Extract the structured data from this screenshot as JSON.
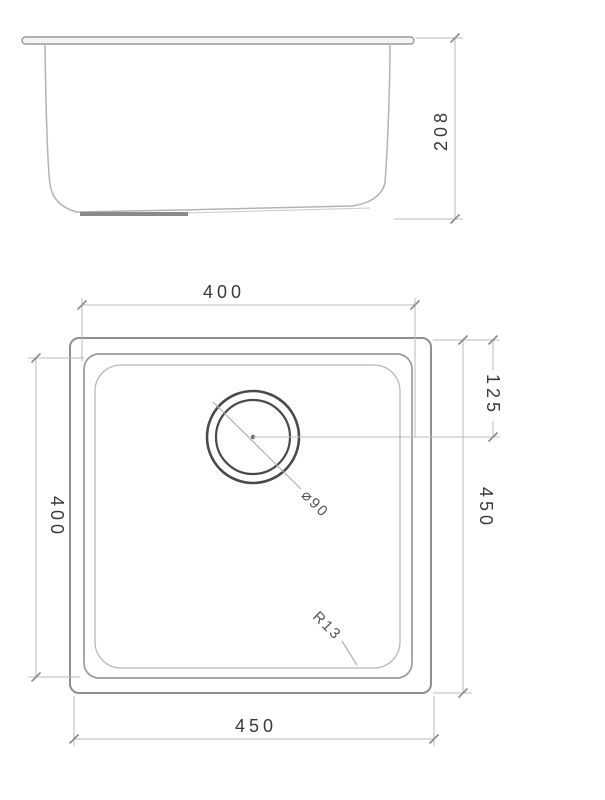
{
  "drawing": {
    "side_view": {
      "height_dim": "208"
    },
    "plan_view": {
      "top_width_dim": "400",
      "left_depth_dim": "400",
      "right_height_dim": "450",
      "bottom_width_dim": "450",
      "drain_offset_dim": "125",
      "drain_diameter_label": "⌀90",
      "corner_radius_label": "R13"
    },
    "colors": {
      "object_line": "#9a9a9a",
      "object_line_light": "#b5b5b5",
      "drain_line": "#4a4a4a",
      "dimension_line": "#b9b9b9",
      "tick": "#8a8a8a",
      "text": "#3a3a3a",
      "background": "#ffffff"
    }
  }
}
